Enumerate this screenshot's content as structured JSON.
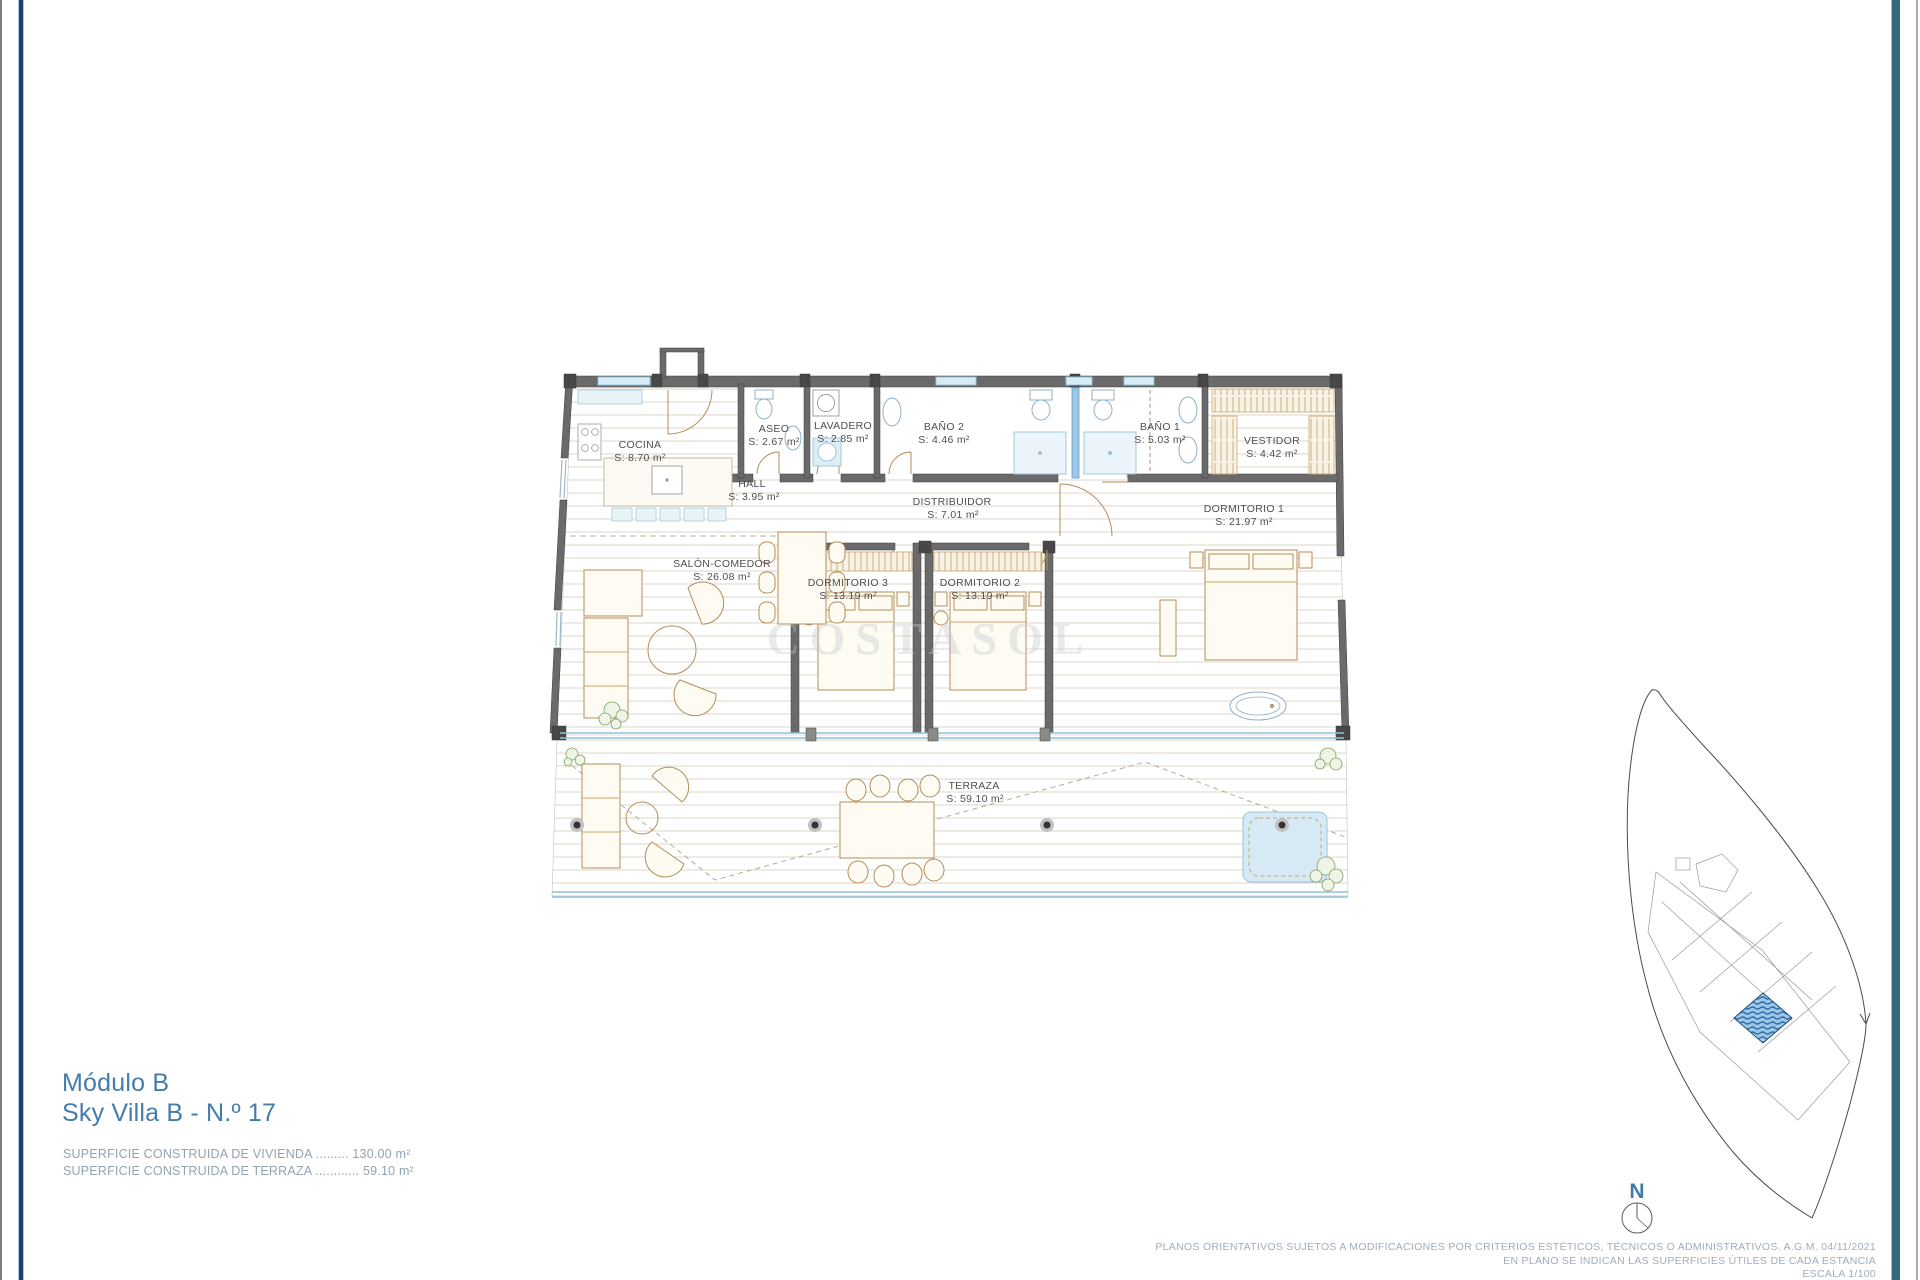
{
  "title_block": {
    "line1": "Módulo B",
    "line2": "Sky Villa B - N.º 17",
    "superficie_vivienda": "SUPERFICIE CONSTRUIDA DE VIVIENDA ......... 130.00 m²",
    "superficie_terraza": "SUPERFICIE CONSTRUIDA DE TERRAZA ............ 59.10 m²"
  },
  "rooms": [
    {
      "name": "COCINA",
      "area": "S: 8.70 m²"
    },
    {
      "name": "ASEO",
      "area": "S: 2.67 m²"
    },
    {
      "name": "LAVADERO",
      "area": "S: 2.85 m²"
    },
    {
      "name": "BAÑO 2",
      "area": "S: 4.46 m²"
    },
    {
      "name": "BAÑO 1",
      "area": "S: 5.03 m²"
    },
    {
      "name": "VESTIDOR",
      "area": "S: 4.42 m²"
    },
    {
      "name": "HALL",
      "area": "S: 3.95 m²"
    },
    {
      "name": "DISTRIBUIDOR",
      "area": "S: 7.01 m²"
    },
    {
      "name": "DORMITORIO 1",
      "area": "S: 21.97 m²"
    },
    {
      "name": "SALÓN-COMEDOR",
      "area": "S: 26.08 m²"
    },
    {
      "name": "DORMITORIO 3",
      "area": "S: 13.19 m²"
    },
    {
      "name": "DORMITORIO 2",
      "area": "S: 13.19 m²"
    },
    {
      "name": "TERRAZA",
      "area": "S: 59.10 m²"
    }
  ],
  "footnotes": {
    "line1": "PLANOS ORIENTATIVOS SUJETOS A MODIFICACIONES POR CRITERIOS ESTÉTICOS, TÉCNICOS O ADMINISTRATIVOS. A.G.M.  04/11/2021",
    "line2": "EN PLANO SE INDICAN LAS SUPERFICIES ÚTILES DE CADA ESTANCIA",
    "line3": "ESCALA 1/100"
  },
  "compass": {
    "label": "N"
  },
  "watermark": {
    "text": "COSTASOL"
  },
  "colors": {
    "accent_blue": "#447bad",
    "text_gray_blue": "#93a3b2",
    "fineprint_gray": "#a0adbb",
    "wall_gray": "#6a6a6a",
    "glazing_blue": "#8fc3da",
    "fixture_blue": "#d6eaf5",
    "furniture_tan": "#b58d5a",
    "site_highlight": "#2d6da3"
  }
}
